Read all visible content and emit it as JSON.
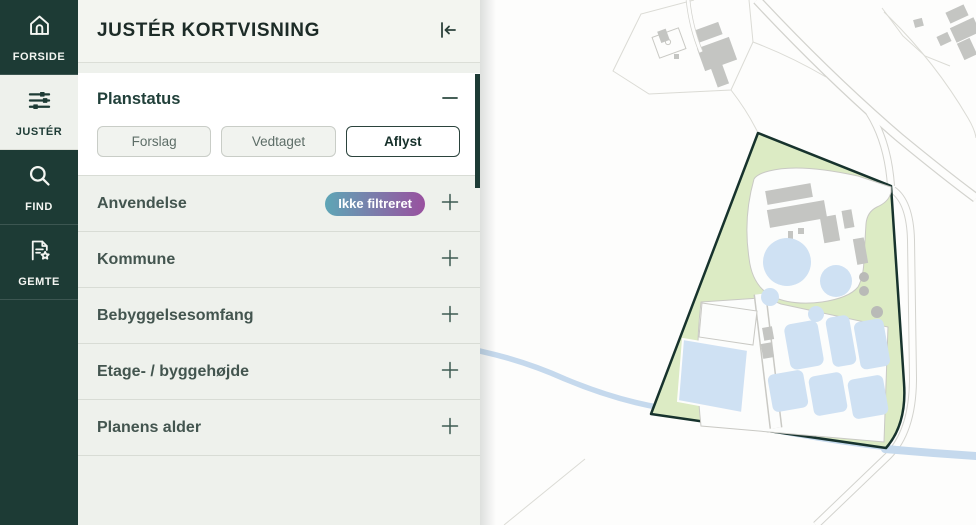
{
  "colors": {
    "sidebar_bg": "#1d3b35",
    "badge_gradient_start": "#5ea6b6",
    "badge_gradient_end": "#99519f",
    "plan_area_fill": "#dcebc4",
    "plan_area_outline": "#17332d",
    "water": "#c5d9ed",
    "building_gray": "#c4c5c2",
    "tank_blue": "#cfe1f3"
  },
  "sidebar": {
    "items": [
      {
        "label": "FORSIDE",
        "icon": "home-icon",
        "active": false
      },
      {
        "label": "JUSTÉR",
        "icon": "sliders-icon",
        "active": true
      },
      {
        "label": "FIND",
        "icon": "search-icon",
        "active": false
      },
      {
        "label": "GEMTE",
        "icon": "saved-plans-icon",
        "active": false
      }
    ]
  },
  "panel": {
    "title": "JUSTÉR KORTVISNING",
    "sections": [
      {
        "label": "Planstatus",
        "expanded": true,
        "options": [
          {
            "label": "Forslag",
            "selected": false
          },
          {
            "label": "Vedtaget",
            "selected": false
          },
          {
            "label": "Aflyst",
            "selected": true
          }
        ]
      },
      {
        "label": "Anvendelse",
        "badge": "Ikke filtreret"
      },
      {
        "label": "Kommune"
      },
      {
        "label": "Bebyggelsesomfang"
      },
      {
        "label": "Etage- / byggehøjde"
      },
      {
        "label": "Planens alder"
      }
    ]
  }
}
